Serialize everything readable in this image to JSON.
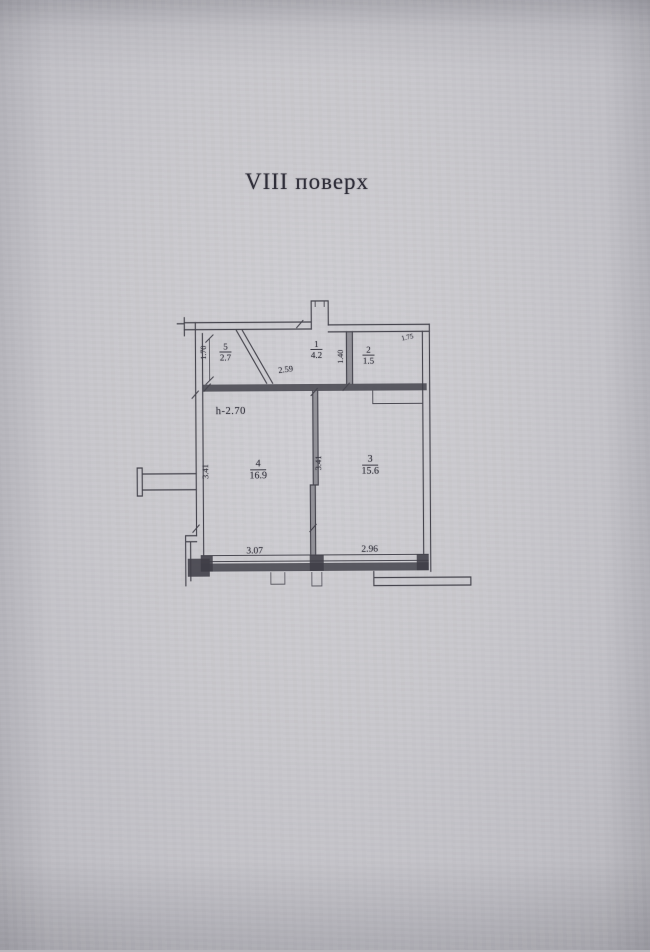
{
  "photo": {
    "title": "VIII поверх"
  },
  "plan": {
    "height_note": "h-2.70",
    "rooms": [
      {
        "number": "5",
        "area": "2.7"
      },
      {
        "number": "1",
        "area": "4.2"
      },
      {
        "number": "2",
        "area": "1.5"
      },
      {
        "number": "4",
        "area": "16.9"
      },
      {
        "number": "3",
        "area": "15.6"
      }
    ],
    "dimensions": {
      "left_top_height": "1.70",
      "hall_width": "2.59",
      "hall_depth": "1.40",
      "wc_width": "1.75",
      "room4_height": "3.41",
      "room3_height": "3.41",
      "room4_width": "3.07",
      "room3_width": "2.96"
    }
  },
  "colors": {
    "paper": "#c8c7cc",
    "ink": "#45444d"
  }
}
